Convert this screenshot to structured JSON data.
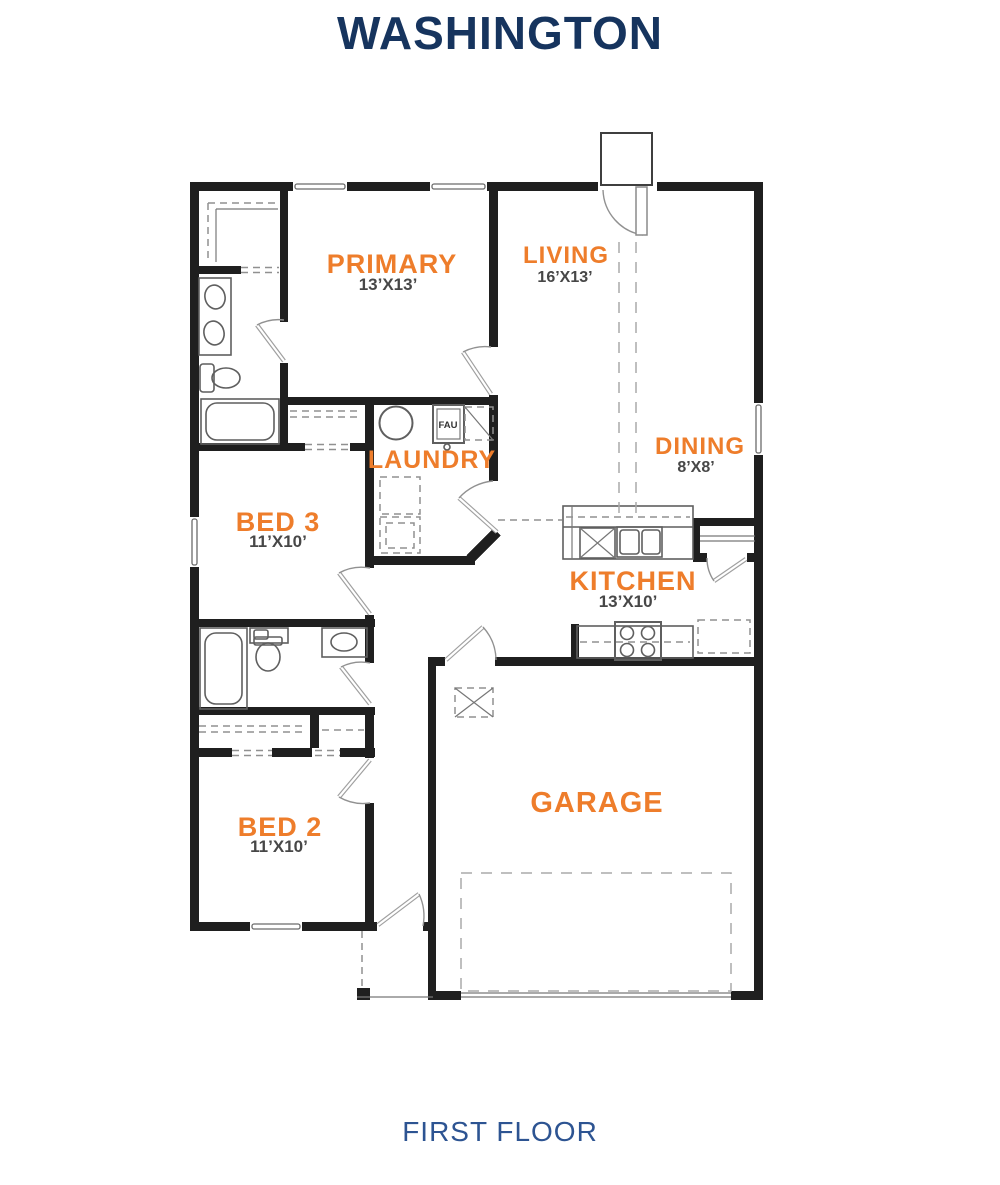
{
  "title": "WASHINGTON",
  "floor_label": "FIRST FLOOR",
  "rooms": {
    "primary": {
      "name": "PRIMARY",
      "dims": "13’X13’"
    },
    "living": {
      "name": "LIVING",
      "dims": "16’X13’"
    },
    "laundry": {
      "name": "LAUNDRY"
    },
    "dining": {
      "name": "DINING",
      "dims": "8’X8’"
    },
    "bed3": {
      "name": "BED 3",
      "dims": "11’X10’"
    },
    "kitchen": {
      "name": "KITCHEN",
      "dims": "13’X10’"
    },
    "bed2": {
      "name": "BED 2",
      "dims": "11’X10’"
    },
    "garage": {
      "name": "GARAGE"
    }
  },
  "equipment": {
    "fau": "FAU"
  },
  "colors": {
    "room_label": "#ee7d2b",
    "dimension_text": "#474747",
    "title_text": "#16345e",
    "floor_text": "#2d5492",
    "wall": "#1f1f1f"
  }
}
